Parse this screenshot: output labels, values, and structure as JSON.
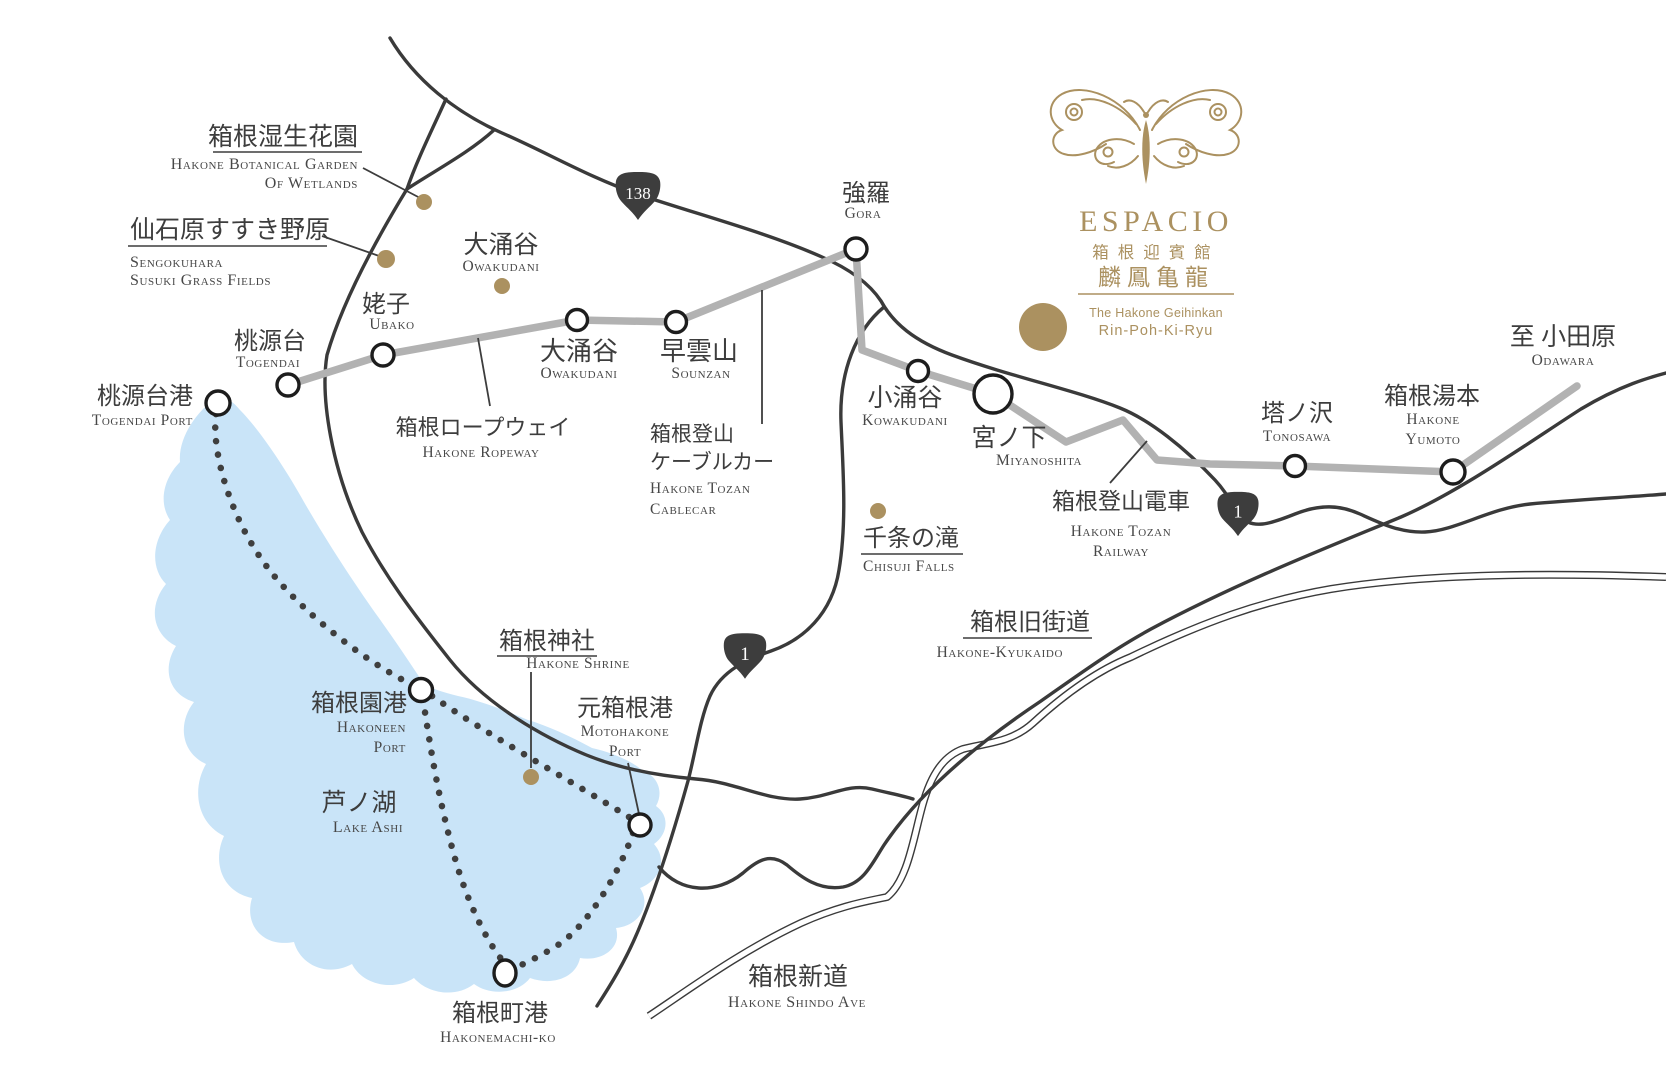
{
  "logo": {
    "brand": "ESPACIO",
    "jp1": "箱根迎賓館",
    "jp2": "麟鳳亀龍",
    "en1": "The Hakone Geihinkan",
    "en2": "Rin-Poh-Ki-Ryu"
  },
  "badges": {
    "r138": "138",
    "r1a": "1",
    "r1b": "1"
  },
  "labels": {
    "botanical": {
      "jp": "箱根湿生花園",
      "en1": "Hakone Botanical Garden",
      "en2": "Of Wetlands"
    },
    "sengokuhara": {
      "jp": "仙石原すすき野原",
      "en1": "Sengokuhara",
      "en2": "Susuki Grass Fields"
    },
    "togendai": {
      "jp": "桃源台",
      "en": "Togendai"
    },
    "ubako": {
      "jp": "姥子",
      "en": "Ubako"
    },
    "togendaiPort": {
      "jp": "桃源台港",
      "en": "Togendai Port"
    },
    "owakudaniArea": {
      "jp": "大涌谷",
      "en": "Owakudani"
    },
    "owakudaniSta": {
      "jp": "大涌谷",
      "en": "Owakudani"
    },
    "sounzan": {
      "jp": "早雲山",
      "en": "Sounzan"
    },
    "gora": {
      "jp": "強羅",
      "en": "Gora"
    },
    "ropeway": {
      "jp": "箱根ロープウェイ",
      "en": "Hakone Ropeway"
    },
    "cablecar": {
      "jp1": "箱根登山",
      "jp2": "ケーブルカー",
      "en1": "Hakone Tozan",
      "en2": "Cablecar"
    },
    "kowakudani": {
      "jp": "小涌谷",
      "en": "Kowakudani"
    },
    "miyanoshita": {
      "jp": "宮ノ下",
      "en": "Miyanoshita"
    },
    "chisuji": {
      "jp": "千条の滝",
      "en": "Chisuji Falls"
    },
    "tozanRailway": {
      "jp": "箱根登山電車",
      "en1": "Hakone Tozan",
      "en2": "Railway"
    },
    "tonosawa": {
      "jp": "塔ノ沢",
      "en": "Tonosawa"
    },
    "yumoto": {
      "jp": "箱根湯本",
      "en1": "Hakone",
      "en2": "Yumoto"
    },
    "odawara": {
      "jp": "至 小田原",
      "en": "Odawara"
    },
    "kyukaido": {
      "jp": "箱根旧街道",
      "en": "Hakone-Kyukaido"
    },
    "shrine": {
      "jp": "箱根神社",
      "en": "Hakone Shrine"
    },
    "hakoneen": {
      "jp": "箱根園港",
      "en1": "Hakoneen",
      "en2": "Port"
    },
    "motohakone": {
      "jp": "元箱根港",
      "en1": "Motohakone",
      "en2": "Port"
    },
    "lakeAshi": {
      "jp": "芦ノ湖",
      "en": "Lake Ashi"
    },
    "hakonemachi": {
      "jp": "箱根町港",
      "en": "Hakonemachi-ko"
    },
    "shindo": {
      "jp": "箱根新道",
      "en": "Hakone Shindo Ave"
    }
  },
  "colors": {
    "gold": "#ab9160",
    "lake": "#c9e4f8",
    "rail": "#b2b2b2",
    "road": "#3a3a3a",
    "ink": "#3d3d3d",
    "badge": "#3d3d3d"
  }
}
